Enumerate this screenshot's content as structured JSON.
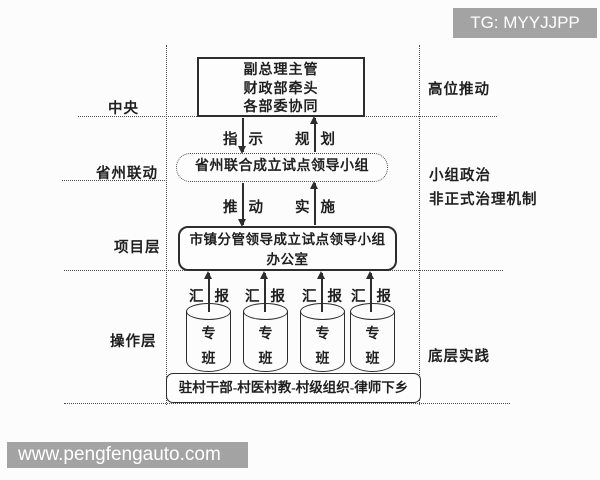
{
  "watermarks": {
    "top_right": "TG: MYYJJPP",
    "bottom_left": "www.pengfengauto.com"
  },
  "colors": {
    "line": "#2d2d2d",
    "dotted_line": "#4a4a4a",
    "watermark_bg": "#a3a3a3",
    "watermark_text": "#ffffff",
    "background": "#fcfcfc"
  },
  "layer_labels": [
    {
      "label": "中央"
    },
    {
      "label": "省州联动"
    },
    {
      "label": "项目层"
    },
    {
      "label": "操作层"
    }
  ],
  "annotations": [
    {
      "label": "高位推动"
    },
    {
      "label": "小组政治"
    },
    {
      "label": "非正式治理机制"
    },
    {
      "label": "底层实践"
    }
  ],
  "nodes": {
    "central": {
      "lines": [
        "副总理主管",
        "财政部牵头",
        "各部委协同"
      ]
    },
    "pilot_group": {
      "label": "省州联合成立试点领导小组"
    },
    "office": {
      "lines": [
        "市镇分管领导成立试点领导小组",
        "办公室"
      ]
    },
    "village": {
      "label": "驻村干部-村医村教-村级组织-律师下乡"
    }
  },
  "arrow_labels": {
    "instruct": {
      "chars": [
        "指",
        "示"
      ]
    },
    "plan": {
      "chars": [
        "规",
        "划"
      ]
    },
    "push": {
      "chars": [
        "推",
        "动"
      ]
    },
    "implement": {
      "chars": [
        "实",
        "施"
      ]
    }
  },
  "report_labels": [
    {
      "chars": [
        "汇",
        "报"
      ]
    },
    {
      "chars": [
        "汇",
        "报"
      ]
    },
    {
      "chars": [
        "汇",
        "报"
      ]
    },
    {
      "chars": [
        "汇",
        "报"
      ]
    }
  ],
  "cylinders": [
    {
      "chars": [
        "专",
        "班"
      ]
    },
    {
      "chars": [
        "专",
        "班"
      ]
    },
    {
      "chars": [
        "专",
        "班"
      ]
    },
    {
      "chars": [
        "专",
        "班"
      ]
    }
  ]
}
